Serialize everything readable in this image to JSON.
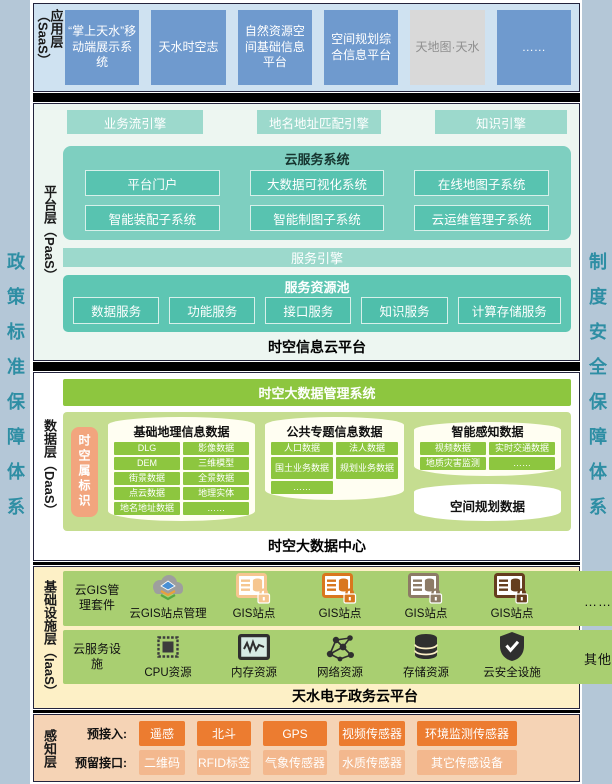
{
  "colors": {
    "pageBg": "#ffffff",
    "stripBg": "#b4c7d7",
    "stripText": "#2e8ea4",
    "saasBg": "#cfe2f1",
    "saasBox": "#6f9ace",
    "saasBoxDisabledBg": "#d9d9d9",
    "saasBoxDisabledText": "#8f8f8f",
    "paasBg": "#edf6f1",
    "tealBar": "#9cd9cc",
    "tealContainer": "#7ecfc0",
    "tealItem": "#58c3b0",
    "poolContainer": "#5ec6b3",
    "poolItem": "#4fbfab",
    "daasBg": "#ffffff",
    "greenBand": "#8dc63f",
    "greenContainer": "#c5dd90",
    "greenItem": "#8dc63f",
    "orangeTag": "#f2a57e",
    "cylinderFill": "#fffef2",
    "iaasBg": "#fdf0c6",
    "iaasBand": "#a9cf71",
    "senseBg": "#f5d3b5",
    "senseDark": "#ec7c30",
    "senseLight": "#f3b88e",
    "sepColor": "#000000"
  },
  "side_left": {
    "text": "政策标准保障体系"
  },
  "side_right": {
    "text": "制度安全保障体系"
  },
  "saas": {
    "layer_label": "应用层（SaaS）",
    "boxes": [
      "“掌上天水”移动端展示系统",
      "天水时空志",
      "自然资源空间基础信息平台",
      "空间规划综合信息平台",
      "天地图·天水",
      "……"
    ]
  },
  "paas": {
    "layer_label": "平台层（PaaS）",
    "engines": [
      "业务流引擎",
      "地名地址匹配引擎",
      "知识引擎"
    ],
    "cloud": {
      "title": "云服务系统",
      "items": [
        "平台门户",
        "大数据可视化系统",
        "在线地图子系统",
        "智能装配子系统",
        "智能制图子系统",
        "云运维管理子系统"
      ]
    },
    "service_engine": "服务引擎",
    "pool": {
      "title": "服务资源池",
      "items": [
        "数据服务",
        "功能服务",
        "接口服务",
        "知识服务",
        "计算存储服务"
      ]
    },
    "caption": "时空信息云平台"
  },
  "daas": {
    "layer_label": "数据层（DaaS）",
    "header": "时空大数据管理系统",
    "tag": "时空属标识",
    "cyl1": {
      "title": "基础地理信息数据",
      "items": [
        "DLG",
        "影像数据",
        "DEM",
        "三维模型",
        "街景数据",
        "全景数据",
        "点云数据",
        "地理实体",
        "地名地址数据",
        "……"
      ]
    },
    "cyl2": {
      "title": "公共专题信息数据",
      "items": [
        "人口数据",
        "法人数据",
        "国土业务数据",
        "规划业务数据",
        "……"
      ]
    },
    "cyl3": {
      "title": "智能感知数据",
      "items": [
        "视频数据",
        "实时交通数据",
        "地质灾害监测",
        "……"
      ]
    },
    "plan_cylinder": "空间规划数据",
    "caption": "时空大数据中心"
  },
  "iaas": {
    "layer_label": "基础设施层（IaaS）",
    "row1": {
      "label": "云GIS管理套件",
      "items": [
        {
          "caption": "云GIS站点管理",
          "icon": "cloud-gis-icon"
        },
        {
          "caption": "GIS站点",
          "icon": "gis-site-icon",
          "color": "#f6c690"
        },
        {
          "caption": "GIS站点",
          "icon": "gis-site-icon",
          "color": "#d9771e"
        },
        {
          "caption": "GIS站点",
          "icon": "gis-site-icon",
          "color": "#8d7b66"
        },
        {
          "caption": "GIS站点",
          "icon": "gis-site-icon",
          "color": "#653d1e"
        },
        {
          "caption": "……",
          "icon": "dots"
        }
      ]
    },
    "row2": {
      "label": "云服务设施",
      "items": [
        {
          "caption": "CPU资源",
          "icon": "cpu-icon"
        },
        {
          "caption": "内存资源",
          "icon": "memory-icon"
        },
        {
          "caption": "网络资源",
          "icon": "network-icon"
        },
        {
          "caption": "存储资源",
          "icon": "storage-icon"
        },
        {
          "caption": "云安全设施",
          "icon": "shield-icon"
        },
        {
          "caption": "其他",
          "icon": "dots"
        }
      ]
    },
    "caption": "天水电子政务云平台"
  },
  "sense": {
    "layer_label": "感知层",
    "row1": {
      "prefix": "预接入:",
      "items": [
        "遥感",
        "北斗",
        "GPS",
        "视频传感器",
        "环境监测传感器"
      ]
    },
    "row2": {
      "prefix": "预留接口:",
      "items": [
        "二维码",
        "RFID标签",
        "气象传感器",
        "水质传感器",
        "其它传感设备"
      ]
    }
  }
}
